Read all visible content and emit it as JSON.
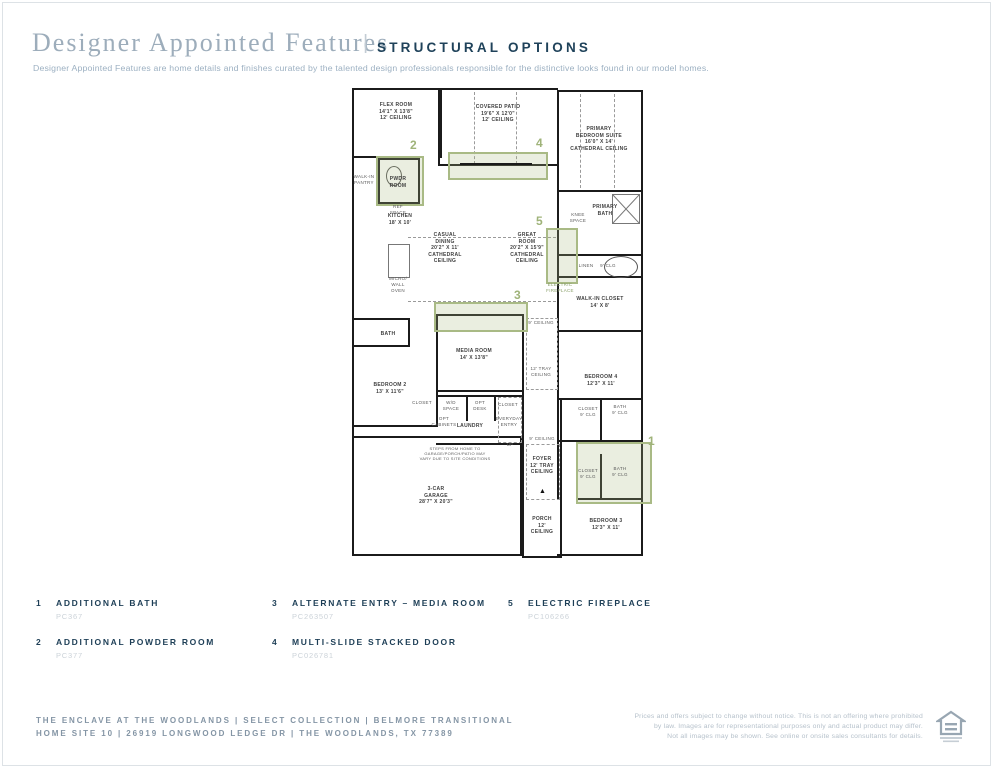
{
  "header": {
    "title": "Designer Appointed Features",
    "divider": "|",
    "section": "STRUCTURAL OPTIONS",
    "description": "Designer Appointed Features are home details and finishes curated by the talented design professionals responsible for the distinctive looks found in our model homes."
  },
  "floorplan": {
    "labels": {
      "flex": [
        "FLEX ROOM",
        "14'1\" X 13'8\"",
        "12' CEILING"
      ],
      "patio": [
        "COVERED PATIO",
        "19'6\" X 12'0\"",
        "12' CEILING"
      ],
      "primary": [
        "PRIMARY",
        "BEDROOM SUITE",
        "16'0\" X 14'",
        "CATHEDRAL CEILING"
      ],
      "pantry": [
        "WALK-IN",
        "PANTRY"
      ],
      "pwdr": [
        "PWDR",
        "ROOM"
      ],
      "refspace": [
        "REF",
        "SPACE"
      ],
      "kitchen": [
        "KITCHEN",
        "18' X 10'"
      ],
      "pbath": [
        "PRIMARY",
        "BATH"
      ],
      "knee": [
        "KNEE",
        "SPACE"
      ],
      "casual": [
        "CASUAL",
        "DINING",
        "20'2\" X 11'",
        "CATHEDRAL",
        "CEILING"
      ],
      "great": [
        "GREAT",
        "ROOM",
        "20'2\" X 15'9\"",
        "CATHEDRAL",
        "CEILING"
      ],
      "efp": [
        "ELECTRIC",
        "FIREPLACE"
      ],
      "linen": [
        "LINEN"
      ],
      "clg9a": [
        "9' CLG"
      ],
      "wic": [
        "WALK-IN CLOSET",
        "14' X 8'"
      ],
      "micro": [
        "MICRO/",
        "WALL",
        "OVEN"
      ],
      "bath_left": [
        "BATH"
      ],
      "media": [
        "MEDIA ROOM",
        "14' X 13'8\""
      ],
      "clg9b": [
        "9' CEILING"
      ],
      "tray": [
        "12' TRAY",
        "CEILING"
      ],
      "bedroom4": [
        "BEDROOM 4",
        "12'3\" X 11'"
      ],
      "bedroom2": [
        "BEDROOM 2",
        "13' X 11'6\""
      ],
      "closet_bd2": [
        "CLOSET"
      ],
      "wd": [
        "W/D",
        "SPACE"
      ],
      "optdesk": [
        "OPT",
        "DESK"
      ],
      "closet_mid": [
        "CLOSET"
      ],
      "laundry": [
        "LAUNDRY"
      ],
      "everyday": [
        "EVERYDAY",
        "ENTRY"
      ],
      "optcab": [
        "OPT",
        "CABINETS"
      ],
      "steps": [
        "STEPS FROM HOME TO",
        "GARAGE/PORCH/PATIO MAY",
        "VARY DUE TO SITE CONDITIONS"
      ],
      "up": [
        "UP"
      ],
      "closet1": [
        "CLOSET",
        "9' CLG"
      ],
      "bath1": [
        "BATH",
        "9' CLG"
      ],
      "clg9c": [
        "9' CEILING"
      ],
      "foyer": [
        "FOYER",
        "12' TRAY",
        "CEILING"
      ],
      "garage": [
        "3-CAR",
        "GARAGE",
        "28'7\" X 20'3\""
      ],
      "porch": [
        "PORCH",
        "12'",
        "CEILING"
      ],
      "closet2": [
        "CLOSET",
        "9' CLG"
      ],
      "bath2": [
        "BATH",
        "9' CLG"
      ],
      "bedroom3": [
        "BEDROOM 3",
        "12'3\" X 11'"
      ]
    },
    "markers": {
      "m1": "1",
      "m2": "2",
      "m3": "3",
      "m4": "4",
      "m5": "5"
    },
    "accent_color": "#9fb379"
  },
  "legend": {
    "items": [
      {
        "num": "1",
        "title": "ADDITIONAL BATH",
        "code": "PC367"
      },
      {
        "num": "2",
        "title": "ADDITIONAL POWDER ROOM",
        "code": "PC377"
      },
      {
        "num": "3",
        "title": "ALTERNATE ENTRY – MEDIA ROOM",
        "code": "PC263507"
      },
      {
        "num": "4",
        "title": "MULTI-SLIDE STACKED DOOR",
        "code": "PC026781"
      },
      {
        "num": "5",
        "title": "ELECTRIC FIREPLACE",
        "code": "PC106266"
      }
    ]
  },
  "footer": {
    "project_line": "THE ENCLAVE AT THE WOODLANDS  |  SELECT COLLECTION  |  BELMORE TRANSITIONAL",
    "address_line": "HOME SITE 10  |  26919 LONGWOOD LEDGE DR |  THE WOODLANDS, TX 77389",
    "disclaimer": [
      "Prices and offers subject to change without notice. This is not an offering where prohibited",
      "by law. Images are for representational purposes only and actual product may differ.",
      "Not all images may be shown. See online or onsite sales consultants for details."
    ],
    "icon": "equal-housing-icon"
  }
}
